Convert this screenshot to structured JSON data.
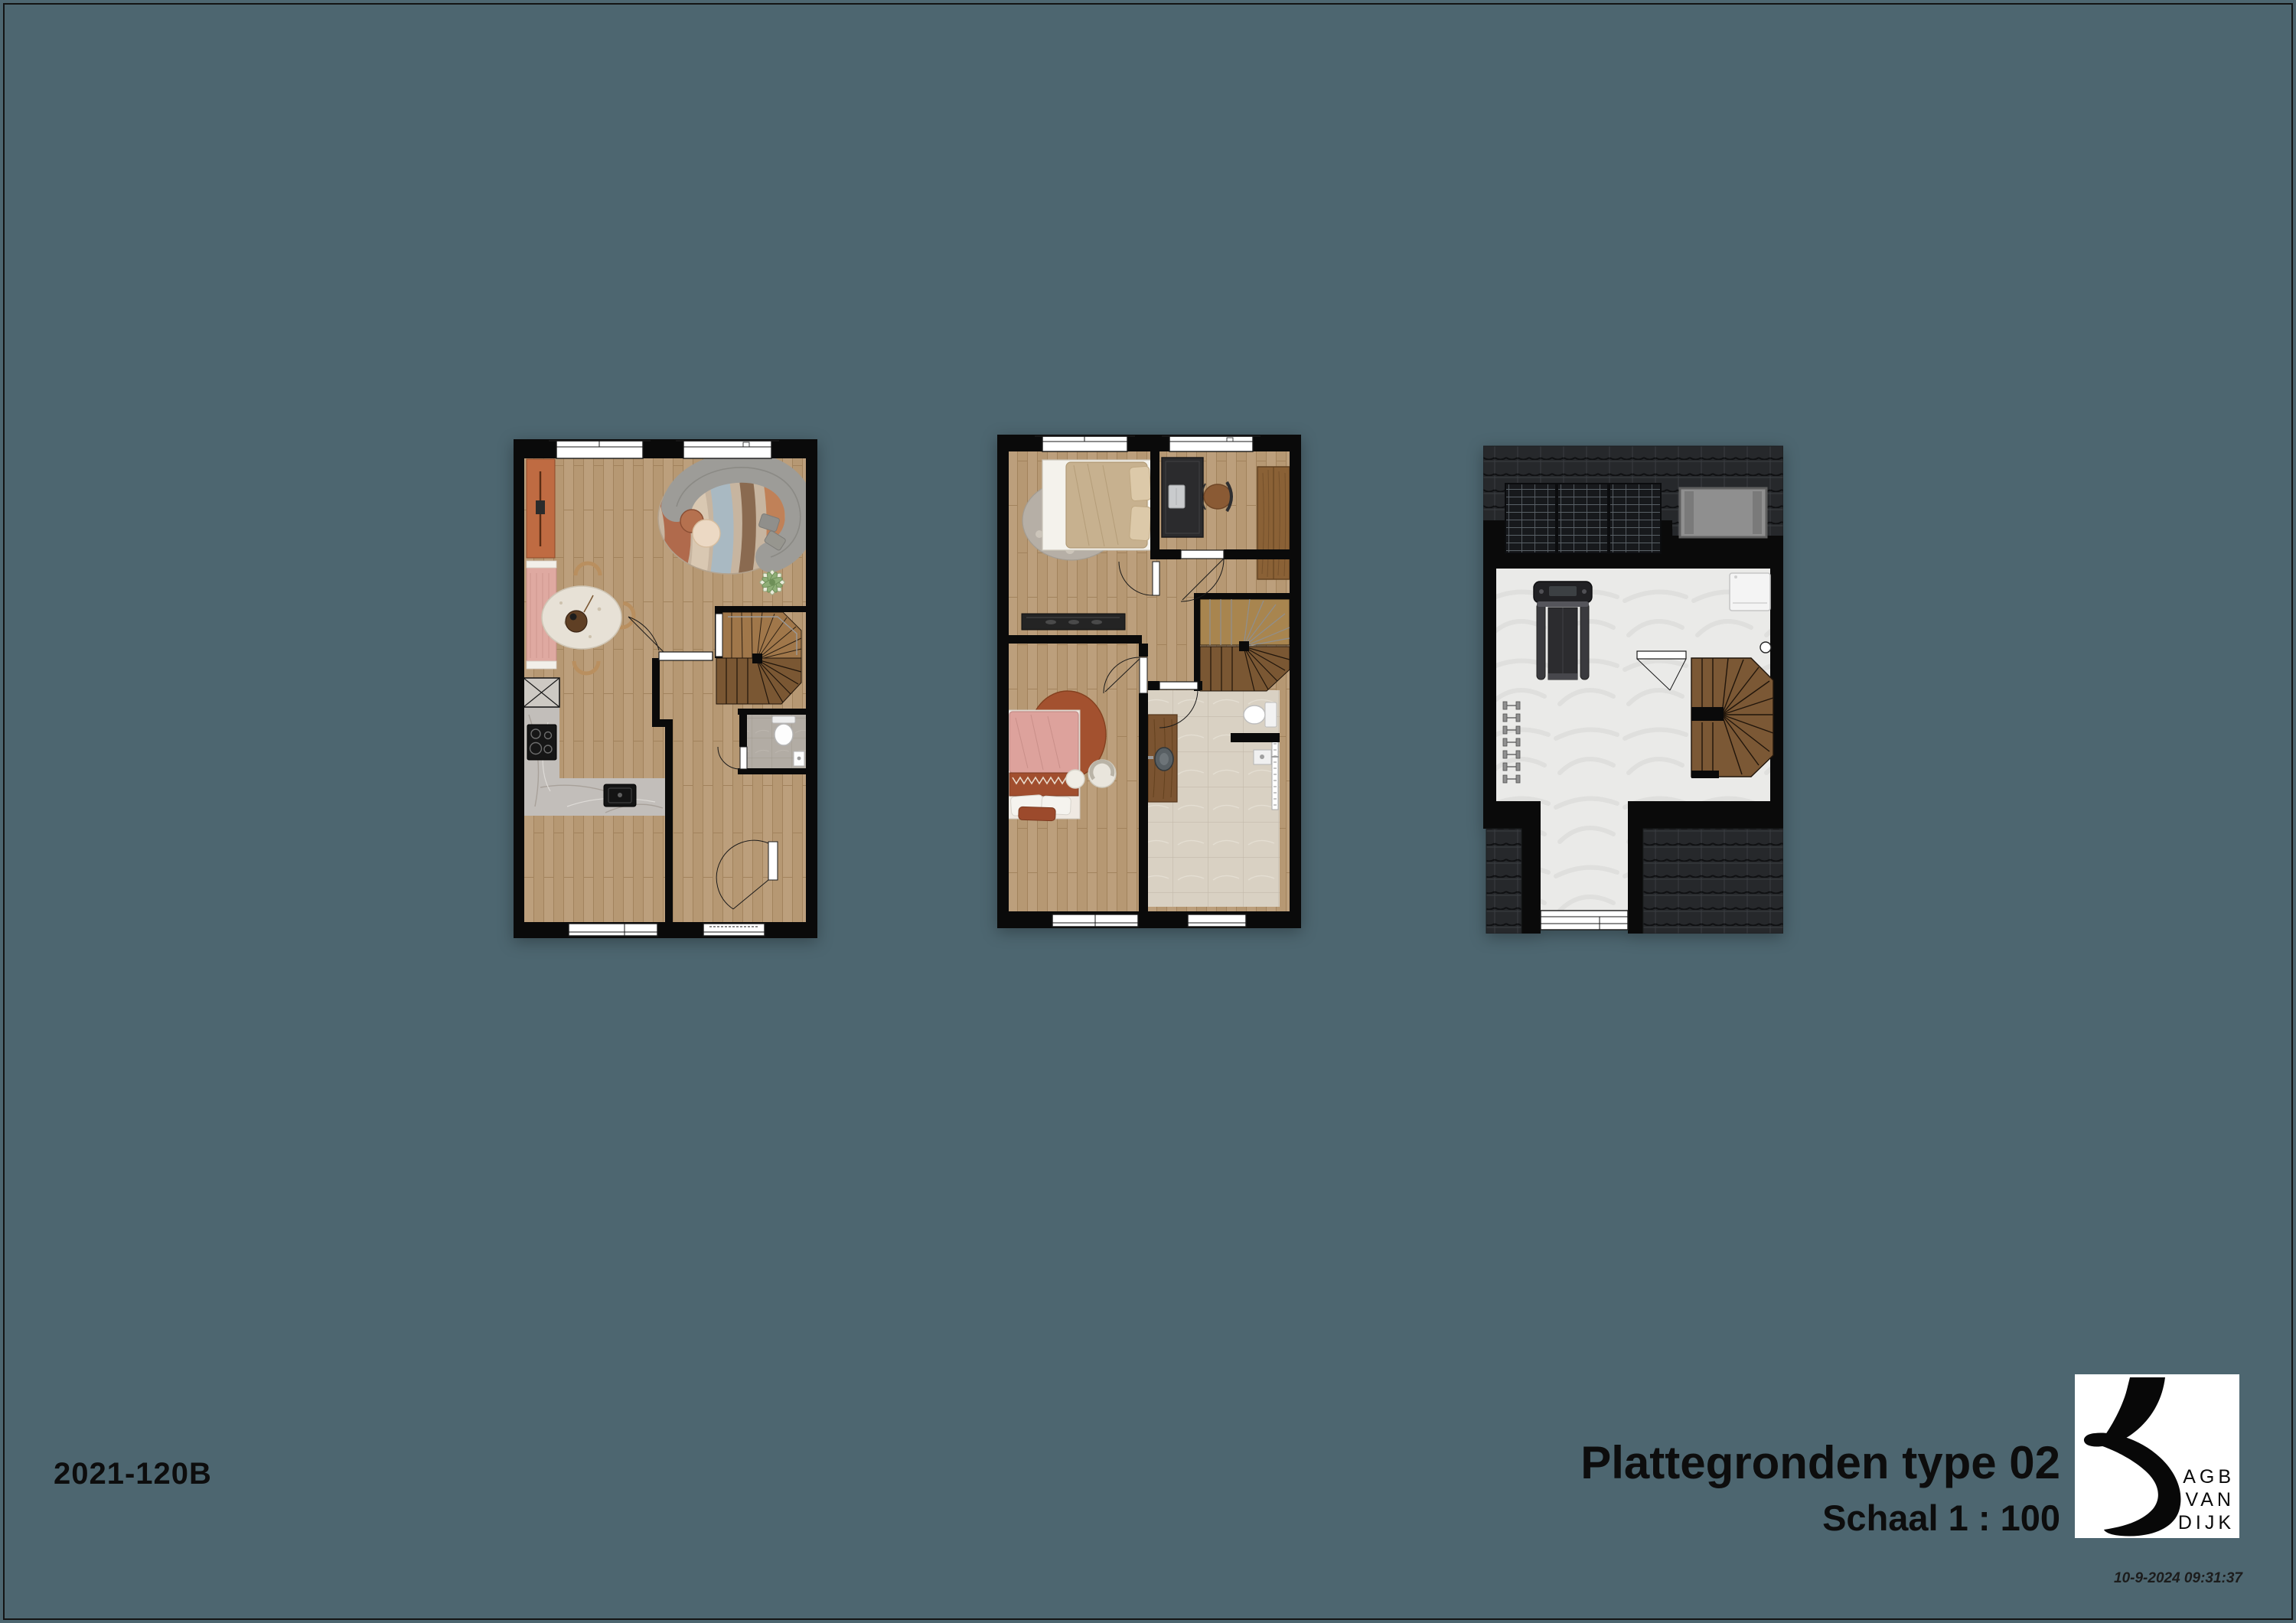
{
  "page": {
    "background_color": "#4d6670",
    "frame_color": "#141414"
  },
  "titleblock": {
    "drawing_number": "2021-120B",
    "title": "Plattegronden type 02",
    "scale": "Schaal  1 : 100",
    "print_timestamp": "10-9-2024 09:31:37"
  },
  "logo": {
    "line1": "AGB",
    "line2": "VAN",
    "line3": "DIJK"
  },
  "plans": {
    "ground_floor": {
      "name": "begane grond",
      "features": [
        "kitchen with tall cabinet, hob, sink and marble worktop",
        "pink bench",
        "round dining table with chairs",
        "curved sofa on round rug",
        "plant",
        "spiral staircase",
        "toilet room",
        "hall with front door",
        "two windows top, two windows bottom"
      ]
    },
    "first_floor": {
      "name": "eerste verdieping",
      "features": [
        "bedroom with double bed and round rug",
        "dresser",
        "office with desk, chair and wardrobe",
        "second bedroom with single bed, armchair and pouf",
        "bathroom with vanity, toilet and shower",
        "spiral staircase",
        "landing with doors"
      ]
    },
    "attic": {
      "name": "zolder",
      "features": [
        "roof tiles",
        "three solar panels",
        "roof window",
        "treadmill",
        "dumbbell rack",
        "washing machine",
        "spiral staircase",
        "bottom dormer window"
      ]
    }
  }
}
